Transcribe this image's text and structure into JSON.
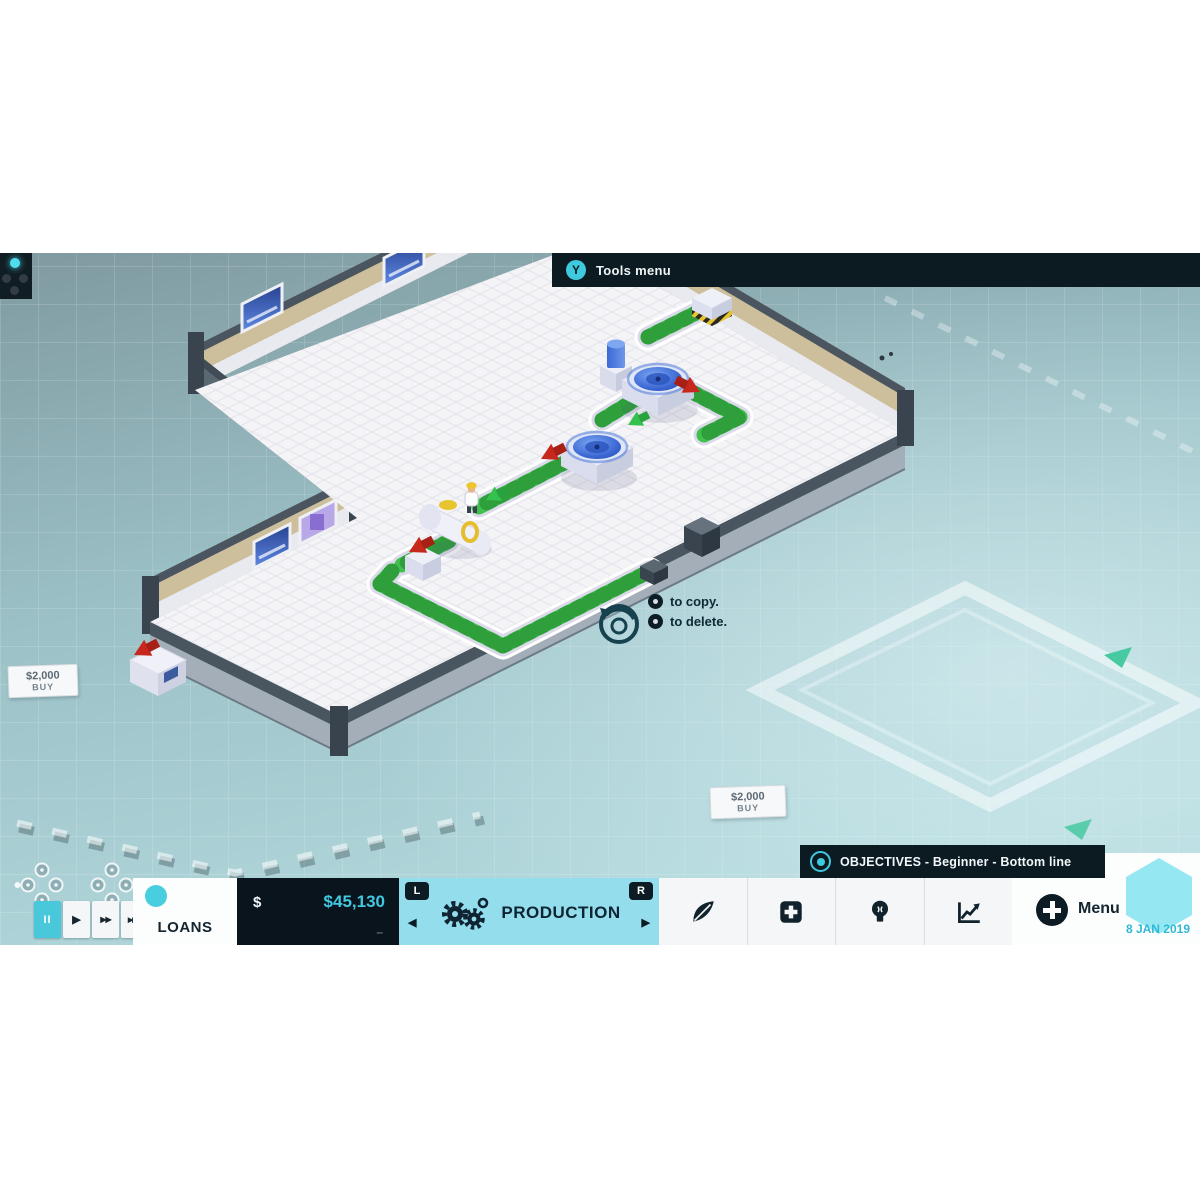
{
  "top_bar": {
    "button": "Y",
    "label": "Tools menu"
  },
  "tooltip": {
    "copy": "to copy.",
    "delete": "to delete."
  },
  "buy_labels": [
    {
      "price": "$2,000",
      "action": "BUY"
    },
    {
      "price": "$2,000",
      "action": "BUY"
    }
  ],
  "objectives_bar": {
    "label": "OBJECTIVES - Beginner - Bottom line"
  },
  "hud": {
    "speed_controls": {
      "pause": "II",
      "play": "▶",
      "fast": "▶▶",
      "fastest": "▶▶▶"
    },
    "loans_button": "LOANS",
    "money": {
      "currency": "$",
      "balance": "$45,130",
      "delta": "–"
    },
    "production_tab": {
      "label": "PRODUCTION",
      "bumper_left": "L",
      "bumper_right": "R",
      "arrow_left": "◀",
      "arrow_right": "▶"
    },
    "tabs": [
      {
        "icon": "leaf-icon"
      },
      {
        "icon": "plus-square-icon"
      },
      {
        "icon": "lightbulb-icon"
      },
      {
        "icon": "chart-icon"
      }
    ],
    "menu": {
      "label": "Menu",
      "date": "8 JAN 2019"
    }
  },
  "colors": {
    "accent_cyan": "#45cede",
    "money_cyan": "#41c9e2",
    "navy": "#0c1a22",
    "production_bg": "#94ddec",
    "belt_green": "#41c04e",
    "wall_tan": "#cdbf9b"
  }
}
